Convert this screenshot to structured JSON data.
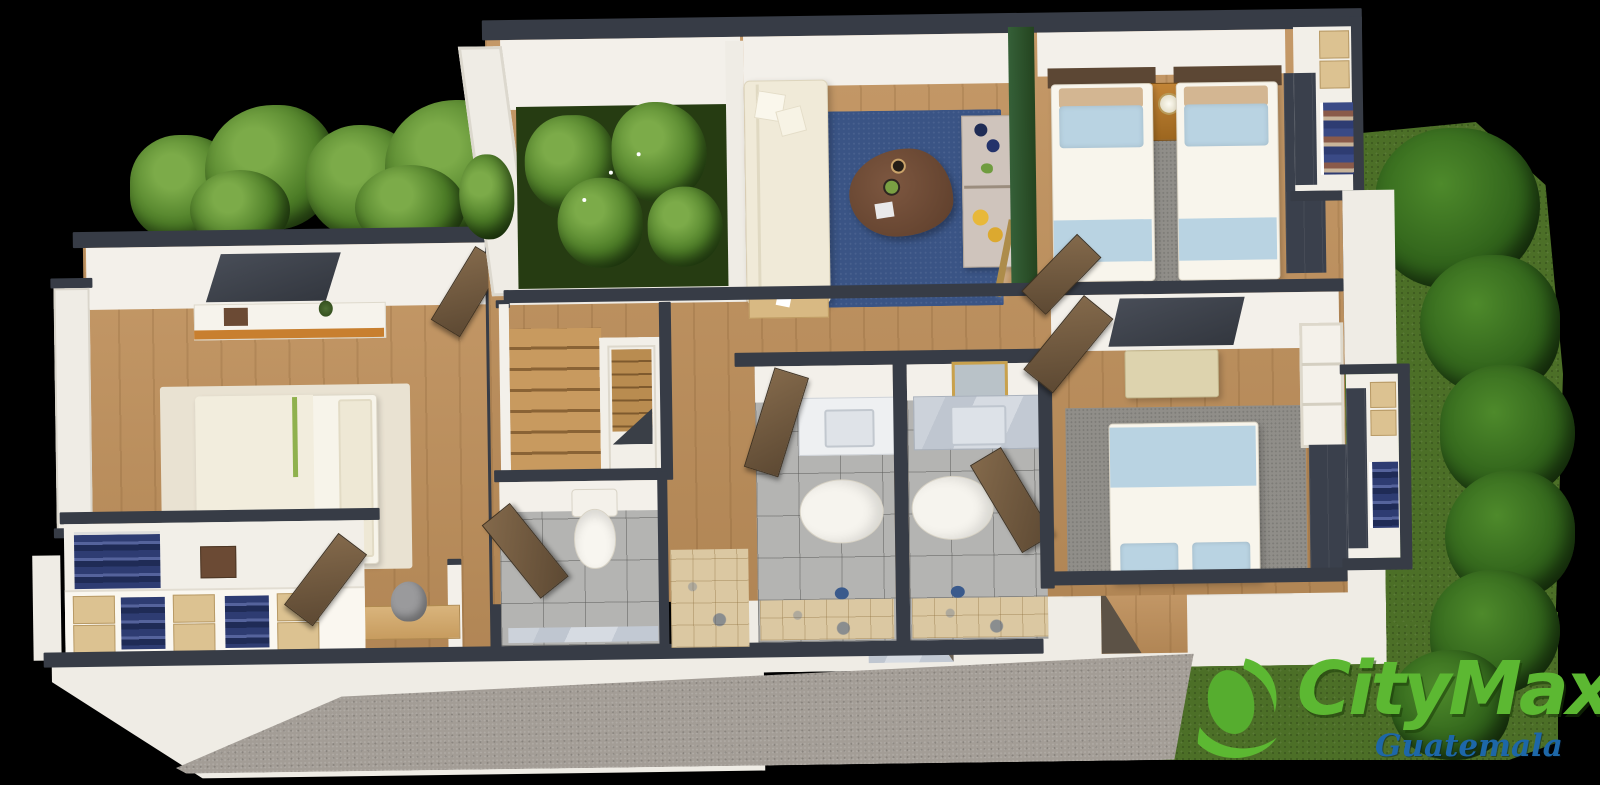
{
  "brand": {
    "name": "CityMax",
    "registered": "®",
    "region": "Guatemala",
    "colors": {
      "logo_green": "#5cb832",
      "logo_blue": "#1d67a8"
    }
  },
  "scene": {
    "type": "3d-floor-plan-render",
    "background": "#000000",
    "rooms": [
      "master-bedroom",
      "walk-in-closet",
      "desk-nook",
      "interior-courtyard",
      "staircase",
      "powder-room",
      "entry-hall",
      "living-room",
      "bar-console",
      "twin-bedroom",
      "bedroom",
      "bathroom-1",
      "bathroom-2",
      "closet-right",
      "front-facade",
      "driveway",
      "garden"
    ],
    "palette": {
      "wall_top": "#373c46",
      "wall_face": "#f3f0ea",
      "wood_floor": "#c0915c",
      "rug_navy": "#3a5485",
      "rug_gray": "#908e89",
      "rug_cream": "#e9e2d2",
      "courtyard_green": "#263c12",
      "grass": "#4c6f27",
      "hedge": "#2f611a",
      "tile_gray": "#b4b4b2",
      "tile_travertine": "#dbc8a2",
      "accent_green_partition": "#2d5130",
      "bed_blue": "#b9d3e2",
      "door_wood": "#6f5a41",
      "wardrobe_navy": "#3a404c",
      "driveway_gravel": "#a39d96"
    }
  }
}
